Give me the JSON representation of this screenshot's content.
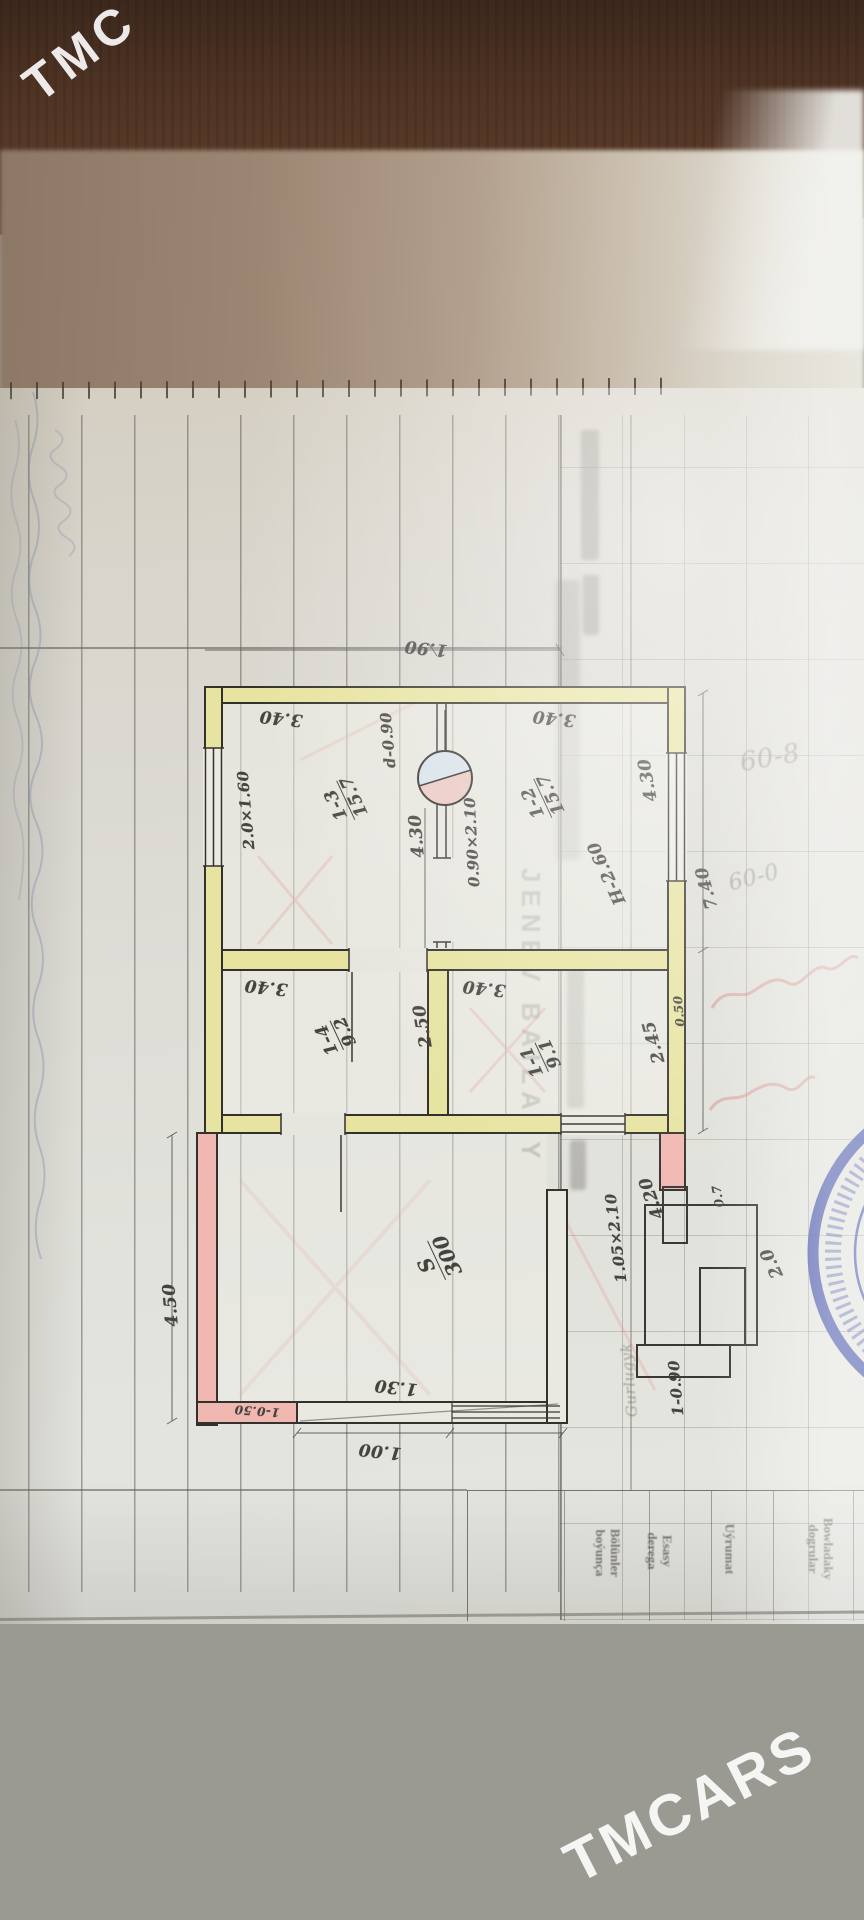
{
  "photo": {
    "watermark_top_left": "TMC",
    "watermark_bottom_right": "TMCARS"
  },
  "plan": {
    "rooms": [
      {
        "id": "1-3",
        "area": "15.7"
      },
      {
        "id": "1-2",
        "area": "15.7"
      },
      {
        "id": "1-4",
        "area": "9.2"
      },
      {
        "id": "1-1",
        "area": "9.1"
      }
    ],
    "veranda": {
      "label": "S",
      "area": "300",
      "side": "4.50",
      "wall_note": "1-0.50"
    },
    "dims": {
      "top_width": "1.90",
      "room_1_3_width": "3.40",
      "room_1_2_width": "3.40",
      "room_1_4_width": "3.40",
      "room_1_1_width": "3.40",
      "left_window": "2.0×1.60",
      "right_window": "4.30",
      "house_depth": "7.40",
      "ceiling_height": "H-2.60",
      "stove_diameter": "d-0.90",
      "stove_offset": "4.30",
      "inner_door": "0.90×2.10",
      "room_1_4_depth": "2.50",
      "room_1_1_depth": "2.45",
      "wall_thickness": "0.50",
      "bottom_a": "1.30",
      "bottom_b": "1.00",
      "entry_door": "1.05×2.10",
      "entry_width": "4.20",
      "entry_wall": "1-0.90",
      "porch_depth": "2.0",
      "porch_step": "0.7"
    },
    "notes": {
      "entry_word": "Gurlugyk"
    },
    "pencil": [
      "60-8",
      "60-0"
    ]
  },
  "form": {
    "stamp_text": "JENEV BAILASY",
    "table_headers": [
      {
        "line1": "Bölünler",
        "line2": "boýunça"
      },
      {
        "line1": "Esasy",
        "line2": "derega"
      },
      {
        "line1": "Uýrumat",
        "line2": ""
      },
      {
        "line1": "Bowladaky",
        "line2": "dogrular"
      }
    ]
  }
}
